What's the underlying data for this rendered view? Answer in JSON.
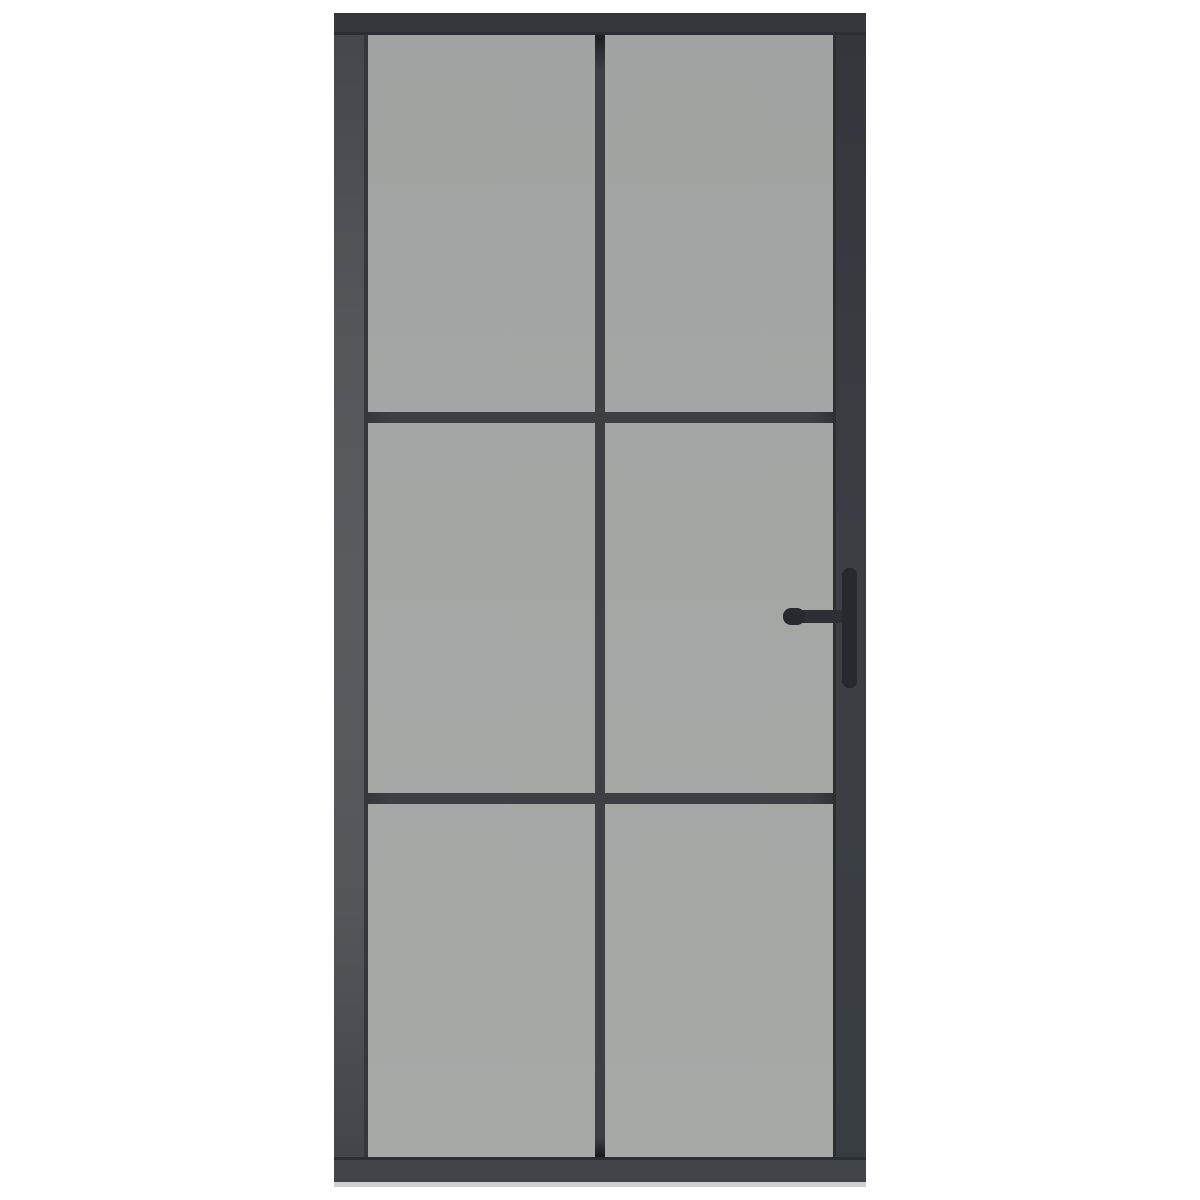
{
  "product": {
    "name": "interior-glass-door",
    "description": "Interior door with anthracite black metal frame, smoked grey ESG glass divided into 6 panes (2 columns x 3 rows) by black muntin bars, with a black lever handle and pull bar on the right side",
    "grid": {
      "columns": 2,
      "rows": 3,
      "pane_count": 6
    },
    "handle": {
      "side": "right",
      "type": "lever-with-pull-bar"
    },
    "visible_text": ""
  },
  "colors": {
    "background": "#ffffff",
    "frame": "#3a3e43",
    "frame_top": "#34383c",
    "frame_bottom": "#41454a",
    "frame_inner_edge": "#2b2f33",
    "frame_inner_edge_left": "#34383c",
    "glass_top": "#a1a4a2",
    "glass_bottom": "#a7a9a7",
    "divider": "#3c4043",
    "handle": "#26292d",
    "handle_lever": "#2c2f33",
    "bottom_edge_highlight": "#cdcfd0"
  }
}
